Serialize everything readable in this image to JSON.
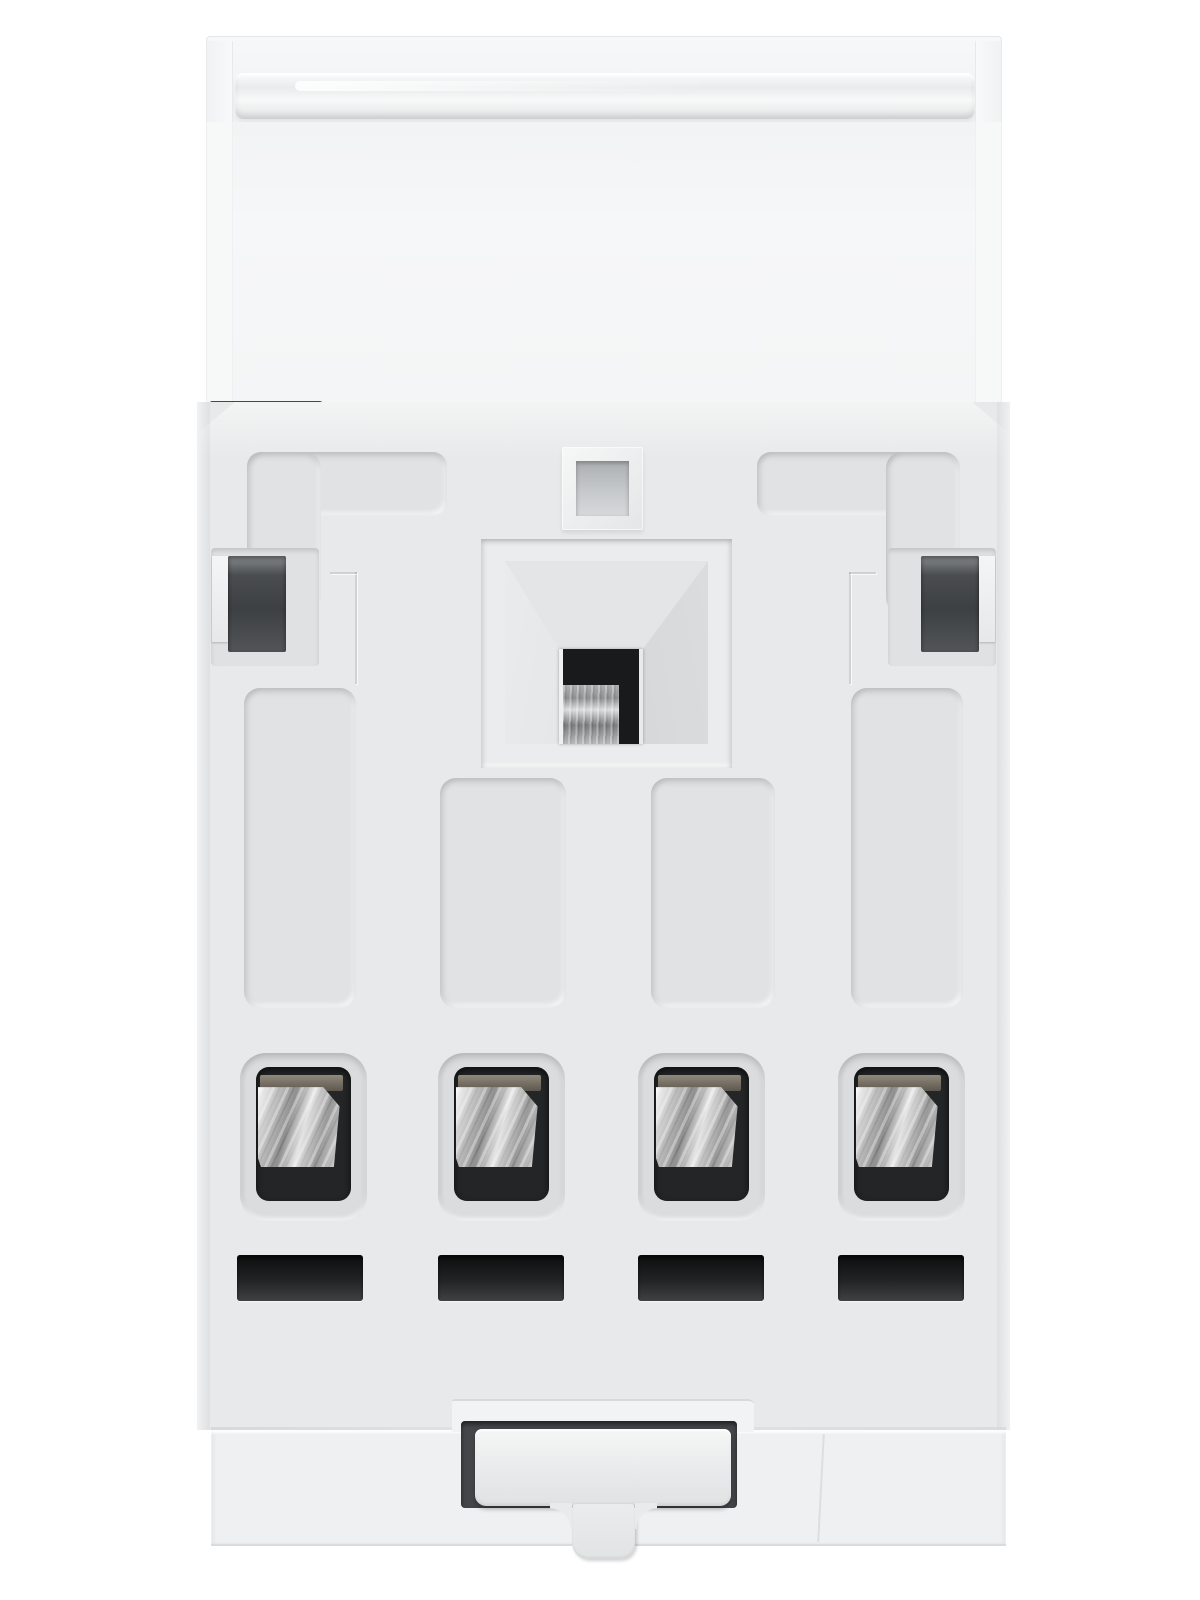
{
  "scene": {
    "type": "product-photograph",
    "subject": "Rear view of a white modular DIN-rail electrical device",
    "background": "#ffffff"
  },
  "parts": {
    "label_holder": "transparent label cover flap with hinge band",
    "mounting_face": "molded rear mounting face with recessed grooves",
    "fixing_hole_small": "small square fixing hole",
    "screw_recess": "central funnel recess with terminal screw visible",
    "side_latch_left": "left side latch opening",
    "side_latch_right": "right side latch opening",
    "terminal_openings": {
      "count": 4,
      "content": "steel clamp visible inside each opening"
    },
    "vent_slots": {
      "count": 4
    },
    "din_rail_clip": "DIN-rail spring clip in dark recess",
    "release_tab": "clip release stem with rounded tip"
  },
  "colors": {
    "background": "#ffffff",
    "top_face": "#f5f6f7",
    "body": "#e8e9ea",
    "groove": "#e0e2e3",
    "recess_slope": "#d6d8da",
    "dark_opening": "#3e4143",
    "terminal_cavity": "#232526",
    "metal_bright": "#f2f2f2",
    "metal_mid": "#9a9a9a",
    "slot_dark": "#141414",
    "clip_recess": "#44474a",
    "clip": "#ececed",
    "bottom_section": "#eff0f1"
  }
}
